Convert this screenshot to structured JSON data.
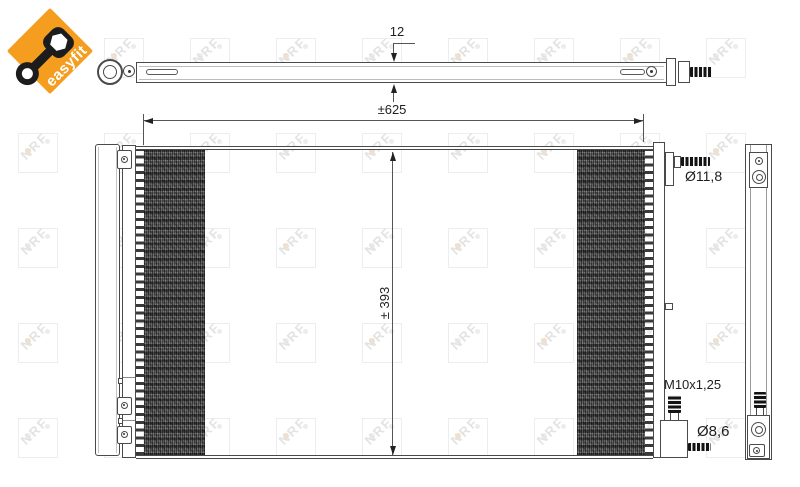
{
  "logo": {
    "text": "easyfit",
    "brand_color": "#F49D1E"
  },
  "watermark": {
    "letters": "NRF"
  },
  "dimensions": {
    "thickness": "12",
    "width": "±625",
    "height": "± 393",
    "top_port_diameter": "Ø11,8",
    "bottom_thread": "M10x1,25",
    "bottom_port_diameter": "Ø8,6"
  },
  "colors": {
    "line": "#4a4a4a",
    "dim_text": "#1e1e1e",
    "fin_dark": "#2c2c2c"
  }
}
